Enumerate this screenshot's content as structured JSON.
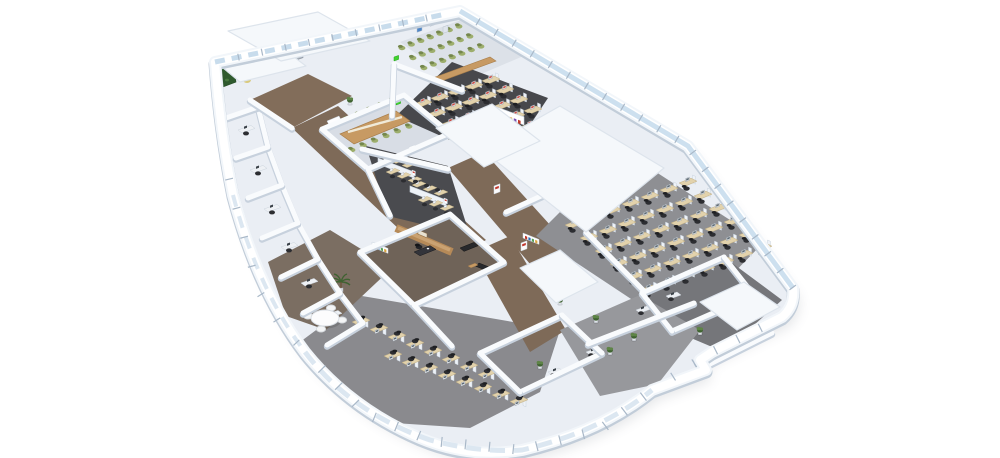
{
  "scene": {
    "canvas": {
      "width": 1000,
      "height": 458,
      "background": "#ffffff"
    },
    "palette": {
      "wallTop": "#f9fbfd",
      "wallEdge": "#c7d1dd",
      "wallBand": "#f2f6fa",
      "wallShade": "#c2cdd9",
      "floorBase": "#eaeef4",
      "roof": "#f5f8fb",
      "roofEdge": "#dde4ec",
      "glass": "#cde0ef",
      "glassLight": "#dce7f1",
      "glassDoor": "#c8dcec",
      "mullion": "#a9b8c8",
      "desk": "#e2d2ac",
      "deskEdge": "#c0ae84",
      "partition": "#eef2f7",
      "partitionEdge": "#c9d3de",
      "chair": "#2c2d31",
      "chairDark": "#1f2023",
      "chairGreen": "#9dae6c",
      "chairGreenEdge": "#75874d",
      "monitor": "#f4f6f8",
      "monitorEdge": "#8c96a1",
      "screenRed": "#c64a42",
      "screenGray": "#5d6a74",
      "wood": "#c79a63",
      "woodDark": "#a87e4b",
      "execWood": "#b68a58",
      "execWoodLight": "#caa272",
      "sofa": "#28292c",
      "plant": "#5e8447",
      "plantDark": "#3f6231",
      "white": "#ffffff",
      "redSign": "#c0362c",
      "signGreen": "#3fd32f",
      "shadow": "#5f6875",
      "shelfColors": [
        "#c0392b",
        "#2e6fb7",
        "#58a05a",
        "#d8a23f",
        "#7a4fb0"
      ]
    },
    "outline": "M215,62 L460,11 L688,146 L793,288 Q795,306 782,317 L712,352 L700,360 L706,370 L652,390 Q600,432 522,450 Q470,459 420,438 Q350,408 305,352 Q258,290 233,195 Q220,130 215,62 Z",
    "zones": [
      {
        "name": "floor-lobe",
        "pts": "300,342 362,296 560,330 540,392 470,428 380,422 322,372",
        "fill": "#8a8a8e"
      },
      {
        "name": "floor-lounge",
        "pts": "268,262 330,230 392,268 326,330 286,316",
        "fill": "#7b6e62"
      },
      {
        "name": "floor-corridor-entry",
        "pts": "250,100 308,74 352,96 292,128",
        "fill": "#826d5a"
      },
      {
        "name": "floor-corridor-main",
        "pts": "292,128 338,106 486,240 438,266",
        "fill": "#7e6a58"
      },
      {
        "name": "floor-corridor-right",
        "pts": "448,168 484,152 580,258 542,278",
        "fill": "#7e6a58"
      },
      {
        "name": "floor-corridor-exec",
        "pts": "474,252 510,236 566,330 530,352",
        "fill": "#7e6a58"
      },
      {
        "name": "floor-conference-room",
        "pts": "322,129 404,95 450,133 368,169",
        "fill": "#d8dde5"
      },
      {
        "name": "floor-training-room",
        "pts": "400,42 464,19 528,54 458,84",
        "fill": "#dce1e8"
      },
      {
        "name": "floor-open-office-north",
        "pts": "452,62 548,98 504,164 396,116",
        "fill": "#47484c"
      },
      {
        "name": "floor-team-cluster",
        "pts": "366,146 448,166 470,236 388,216",
        "fill": "#4a4b4f"
      },
      {
        "name": "floor-executive-office",
        "pts": "360,252 450,214 504,262 414,305",
        "fill": "#6f6358"
      },
      {
        "name": "floor-cubicle-farm",
        "pts": "536,236 622,150 764,242 678,330",
        "fill": "#8e8f93"
      },
      {
        "name": "floor-rooms-right",
        "pts": "642,293 724,257 782,300 724,352 672,330",
        "fill": "#75767a"
      },
      {
        "name": "floor-rooms-bottom",
        "pts": "560,330 640,295 700,330 658,384 600,396",
        "fill": "#97989c"
      }
    ],
    "roofs": [
      {
        "name": "roof-entrance-left",
        "pts": "216,62 282,48 306,66 240,82"
      },
      {
        "name": "roof-entrance-top",
        "pts": "228,31 318,12 370,41 281,61"
      },
      {
        "name": "roof-core",
        "pts": "482,150 560,106 664,168 586,232"
      },
      {
        "name": "roof-mid",
        "pts": "436,128 492,104 540,141 484,167"
      },
      {
        "name": "roof-right-small",
        "pts": "700,302 744,282 780,307 737,330"
      },
      {
        "name": "roof-exec-side",
        "pts": "520,268 560,250 598,282 556,303"
      }
    ],
    "walls": [
      {
        "name": "wall-conference",
        "pts": [
          [
            322,
            129
          ],
          [
            404,
            95
          ],
          [
            450,
            133
          ],
          [
            368,
            169
          ],
          [
            322,
            129
          ]
        ]
      },
      {
        "name": "wall-training-divider",
        "pts": [
          [
            394,
            64
          ],
          [
            462,
            90
          ]
        ]
      },
      {
        "name": "wall-north-left",
        "pts": [
          [
            394,
            64
          ],
          [
            392,
            116
          ]
        ]
      },
      {
        "name": "wall-cabinet-team",
        "pts": [
          [
            362,
            149
          ],
          [
            448,
            169
          ]
        ]
      },
      {
        "name": "wall-team-left",
        "pts": [
          [
            368,
            169
          ],
          [
            390,
            215
          ]
        ]
      },
      {
        "name": "wall-executive",
        "pts": [
          [
            360,
            252
          ],
          [
            450,
            214
          ],
          [
            504,
            262
          ],
          [
            414,
            305
          ],
          [
            360,
            252
          ]
        ]
      },
      {
        "name": "wall-core-east",
        "pts": [
          [
            586,
            232
          ],
          [
            644,
            291
          ]
        ]
      },
      {
        "name": "wall-farm-west",
        "pts": [
          [
            506,
            212
          ],
          [
            598,
            170
          ]
        ]
      },
      {
        "name": "wall-offices-inner",
        "pts": [
          [
            258,
            107
          ],
          [
            268,
            147
          ],
          [
            282,
            185
          ],
          [
            298,
            223
          ],
          [
            318,
            259
          ],
          [
            340,
            293
          ],
          [
            363,
            323
          ]
        ]
      },
      {
        "name": "wall-office-p1",
        "pts": [
          [
            226,
            118
          ],
          [
            258,
            107
          ]
        ]
      },
      {
        "name": "wall-office-p2",
        "pts": [
          [
            236,
            158
          ],
          [
            268,
            147
          ]
        ]
      },
      {
        "name": "wall-office-p3",
        "pts": [
          [
            248,
            198
          ],
          [
            282,
            185
          ]
        ]
      },
      {
        "name": "wall-office-p4",
        "pts": [
          [
            262,
            238
          ],
          [
            298,
            223
          ]
        ]
      },
      {
        "name": "wall-office-p5",
        "pts": [
          [
            281,
            277
          ],
          [
            318,
            259
          ]
        ]
      },
      {
        "name": "wall-office-p6",
        "pts": [
          [
            303,
            313
          ],
          [
            340,
            293
          ]
        ]
      },
      {
        "name": "wall-office-p7",
        "pts": [
          [
            327,
            345
          ],
          [
            363,
            323
          ]
        ]
      },
      {
        "name": "wall-lounge-south",
        "pts": [
          [
            414,
            305
          ],
          [
            452,
            346
          ]
        ]
      },
      {
        "name": "wall-rooms-bottom-1",
        "pts": [
          [
            480,
            353
          ],
          [
            562,
            315
          ]
        ]
      },
      {
        "name": "wall-rooms-bottom-2",
        "pts": [
          [
            520,
            392
          ],
          [
            602,
            353
          ]
        ]
      },
      {
        "name": "wall-rooms-bottom-3",
        "pts": [
          [
            562,
            315
          ],
          [
            602,
            353
          ]
        ]
      },
      {
        "name": "wall-rooms-bottom-4",
        "pts": [
          [
            480,
            353
          ],
          [
            520,
            392
          ]
        ]
      },
      {
        "name": "wall-rooms-right-1",
        "pts": [
          [
            642,
            293
          ],
          [
            724,
            257
          ]
        ]
      },
      {
        "name": "wall-rooms-right-2",
        "pts": [
          [
            672,
            331
          ],
          [
            754,
            295
          ]
        ]
      },
      {
        "name": "wall-rooms-right-3",
        "pts": [
          [
            704,
            367
          ],
          [
            772,
            333
          ]
        ]
      },
      {
        "name": "wall-rooms-right-4",
        "pts": [
          [
            642,
            293
          ],
          [
            672,
            331
          ]
        ]
      },
      {
        "name": "wall-rooms-right-5",
        "pts": [
          [
            724,
            257
          ],
          [
            754,
            295
          ]
        ]
      },
      {
        "name": "wall-farm-south",
        "pts": [
          [
            588,
            344
          ],
          [
            694,
            303
          ]
        ]
      },
      {
        "name": "wall-entry-inner",
        "pts": [
          [
            250,
            100
          ],
          [
            292,
            128
          ]
        ]
      },
      {
        "name": "wall-conference-core",
        "pts": [
          [
            450,
            133
          ],
          [
            484,
            152
          ]
        ]
      }
    ],
    "deskRows": [
      {
        "name": "cubicle-farm-row",
        "v": "A",
        "x": 565,
        "y": 225,
        "dx": 19,
        "dy": -7,
        "n": 7,
        "rows": 6,
        "rx": 15,
        "ry": 13,
        "screen": "#5d6a74"
      },
      {
        "name": "open-office-north-row",
        "v": "A",
        "x": 414,
        "y": 104,
        "dx": 17,
        "dy": -5.8,
        "n": 5,
        "rows": 5,
        "rx": 14,
        "ry": 10,
        "screen": "#c64a42"
      },
      {
        "name": "bottom-cubicle-row-1",
        "v": "B",
        "x": 352,
        "y": 322,
        "dx": 18,
        "dy": 7.5,
        "n": 8,
        "rows": 1,
        "rx": 0,
        "ry": 0,
        "screen": "#5d6a74"
      },
      {
        "name": "bottom-cubicle-row-2",
        "v": "B",
        "x": 384,
        "y": 356,
        "dx": 18,
        "dy": 6.5,
        "n": 8,
        "rows": 1,
        "rx": 0,
        "ry": 0,
        "screen": "#5d6a74"
      }
    ],
    "chairRows": [
      {
        "name": "conference-chairs-top",
        "x": 336,
        "y": 124,
        "dx": 11.4,
        "dy": -4.7,
        "n": 6
      },
      {
        "name": "conference-chairs-bottom",
        "x": 352,
        "y": 150,
        "dx": 11.4,
        "dy": -4.7,
        "n": 6
      },
      {
        "name": "training-chairs-row-1",
        "x": 402,
        "y": 48,
        "dx": 9.5,
        "dy": -3.6,
        "n": 7
      },
      {
        "name": "training-chairs-row-2",
        "x": 413,
        "y": 58,
        "dx": 9.5,
        "dy": -3.6,
        "n": 7
      },
      {
        "name": "training-chairs-row-3",
        "x": 424,
        "y": 68,
        "dx": 9.5,
        "dy": -3.6,
        "n": 7
      }
    ],
    "clusters": [
      {
        "x": 378,
        "y": 164
      },
      {
        "x": 410,
        "y": 192
      }
    ],
    "sideDesks": [
      {
        "x": 238,
        "y": 130
      },
      {
        "x": 250,
        "y": 170
      },
      {
        "x": 264,
        "y": 209
      },
      {
        "x": 281,
        "y": 247
      },
      {
        "x": 301,
        "y": 283
      },
      {
        "x": 325,
        "y": 315
      }
    ],
    "singles": [
      {
        "t": "plantWallGreen",
        "x": 219,
        "y": 58
      },
      {
        "t": "yellowChair",
        "x": 247,
        "y": 80
      },
      {
        "t": "yellowChair",
        "x": 259,
        "y": 73
      },
      {
        "t": "receptionDesk",
        "x": 268,
        "y": 62
      },
      {
        "t": "elevator",
        "x": 287,
        "y": 55
      },
      {
        "t": "greenSign",
        "x": 318,
        "y": 45
      },
      {
        "t": "greenSign",
        "x": 352,
        "y": 37
      },
      {
        "t": "greenSign",
        "x": 394,
        "y": 57
      },
      {
        "t": "greenSign",
        "x": 396,
        "y": 101
      },
      {
        "t": "poster",
        "x": 417,
        "y": 26,
        "c": "#4f86c6"
      },
      {
        "t": "poster",
        "x": 430,
        "y": 20,
        "c": "#dfe5ec"
      },
      {
        "t": "poster",
        "x": 443,
        "y": 27,
        "c": "#dfe5ec"
      },
      {
        "t": "headTable",
        "x": 430,
        "y": 79
      },
      {
        "t": "confTable",
        "x": 340,
        "y": 134
      },
      {
        "t": "whiteboard",
        "x": 327,
        "y": 121
      },
      {
        "t": "redSign",
        "x": 409,
        "y": 147
      },
      {
        "t": "redSign",
        "x": 494,
        "y": 186
      },
      {
        "t": "redSign",
        "x": 521,
        "y": 243
      },
      {
        "t": "shelf",
        "x": 494,
        "y": 114
      },
      {
        "t": "bookshelfColor",
        "x": 372,
        "y": 247
      },
      {
        "t": "bookshelfColor",
        "x": 523,
        "y": 238
      },
      {
        "t": "woodWall",
        "x": 396,
        "y": 228
      },
      {
        "t": "deskExec",
        "x": 414,
        "y": 252
      },
      {
        "t": "sofa",
        "x": 460,
        "y": 248,
        "r": 0
      },
      {
        "t": "sofa",
        "x": 479,
        "y": 263,
        "r": 1
      },
      {
        "t": "coffeeTable",
        "x": 468,
        "y": 266
      },
      {
        "t": "roundTable",
        "x": 325,
        "y": 318
      },
      {
        "t": "palm",
        "x": 341,
        "y": 284
      },
      {
        "t": "plant",
        "x": 560,
        "y": 300
      },
      {
        "t": "plant",
        "x": 596,
        "y": 318
      },
      {
        "t": "plant",
        "x": 634,
        "y": 336
      },
      {
        "t": "plant",
        "x": 540,
        "y": 364
      },
      {
        "t": "plant",
        "x": 610,
        "y": 350
      },
      {
        "t": "plant",
        "x": 700,
        "y": 330
      },
      {
        "t": "plant",
        "x": 350,
        "y": 100
      },
      {
        "t": "deskSide",
        "x": 636,
        "y": 310
      },
      {
        "t": "deskSide",
        "x": 666,
        "y": 296
      },
      {
        "t": "deskSide",
        "x": 586,
        "y": 352
      },
      {
        "t": "deskSide",
        "x": 548,
        "y": 372
      }
    ],
    "glassRuns": [
      {
        "name": "glass-topright",
        "d": "M460,11 L688,146 L793,288",
        "w": 5,
        "c": "#cde0ef",
        "dash": ""
      },
      {
        "name": "glass-bottom",
        "d": "M305,352 Q350,412 430,440 Q480,453 522,450 Q600,432 652,390",
        "w": 5,
        "c": "#dce7f1",
        "dash": "15 9"
      },
      {
        "name": "glass-entrance-doors",
        "d": "M215,62 L446,14",
        "w": 5,
        "c": "#c8dcec",
        "dash": "10 7"
      },
      {
        "name": "glass-left-lower",
        "d": "M233,195 Q258,290 305,352",
        "w": 4,
        "c": "#dce7f1",
        "dash": "12 10"
      }
    ],
    "mullionRuns": [
      {
        "name": "mullions-topright",
        "pts": [
          [
            460,
            11
          ],
          [
            688,
            146
          ],
          [
            793,
            288
          ]
        ],
        "spacing": 21,
        "len": 8
      },
      {
        "name": "mullions-bottom",
        "pts": [
          [
            305,
            352
          ],
          [
            366,
            414
          ],
          [
            432,
            441
          ],
          [
            522,
            450
          ],
          [
            600,
            430
          ],
          [
            652,
            390
          ]
        ],
        "spacing": 24,
        "len": 10
      },
      {
        "name": "mullions-bottomright",
        "pts": [
          [
            652,
            390
          ],
          [
            712,
            352
          ],
          [
            782,
            317
          ]
        ],
        "spacing": 25,
        "len": 9
      },
      {
        "name": "mullions-topleft",
        "pts": [
          [
            215,
            62
          ],
          [
            446,
            14
          ]
        ],
        "spacing": 24,
        "len": 7
      },
      {
        "name": "mullions-left",
        "pts": [
          [
            222,
            150
          ],
          [
            233,
            195
          ],
          [
            258,
            290
          ],
          [
            280,
            325
          ],
          [
            305,
            352
          ]
        ],
        "spacing": 30,
        "len": 8
      }
    ]
  }
}
